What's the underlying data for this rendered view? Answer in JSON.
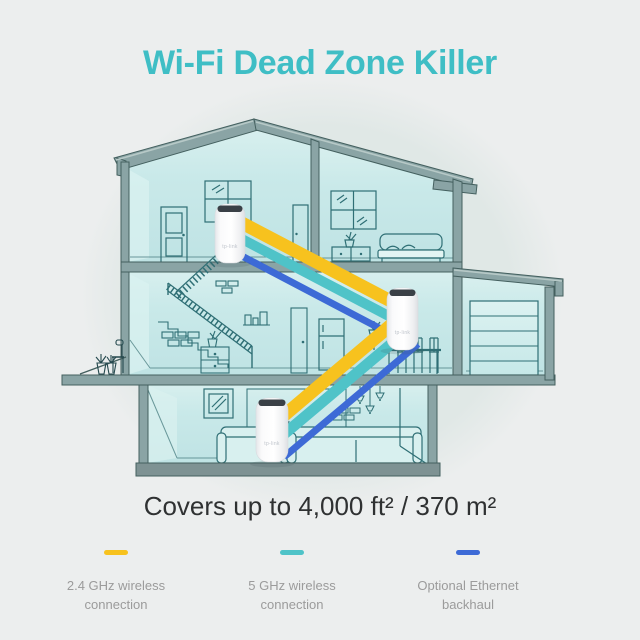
{
  "title": "Wi-Fi Dead Zone Killer",
  "coverage": "Covers up to 4,000 ft² / 370 m²",
  "colors": {
    "title_teal": "#3FBEC5",
    "background": "#ECEEEE",
    "text_dark": "#2F3132",
    "legend_gray": "#9B9B9B",
    "band_24ghz": "#F7C21E",
    "band_5ghz": "#4FC3C8",
    "band_ethernet": "#3D6AD6",
    "house_interior": "#C7E8E8",
    "structure_gray": "#8AA4A5",
    "lineart_teal": "#2F6F75"
  },
  "legend": [
    {
      "id": "24ghz",
      "color_key": "band_24ghz",
      "label": "2.4 GHz wireless connection"
    },
    {
      "id": "5ghz",
      "color_key": "band_5ghz",
      "label": "5 GHz wireless connection"
    },
    {
      "id": "ethernet",
      "color_key": "band_ethernet",
      "label": "Optional Ethernet backhaul"
    }
  ],
  "deco_units": {
    "count": 3,
    "brand_label": "tp-link"
  }
}
